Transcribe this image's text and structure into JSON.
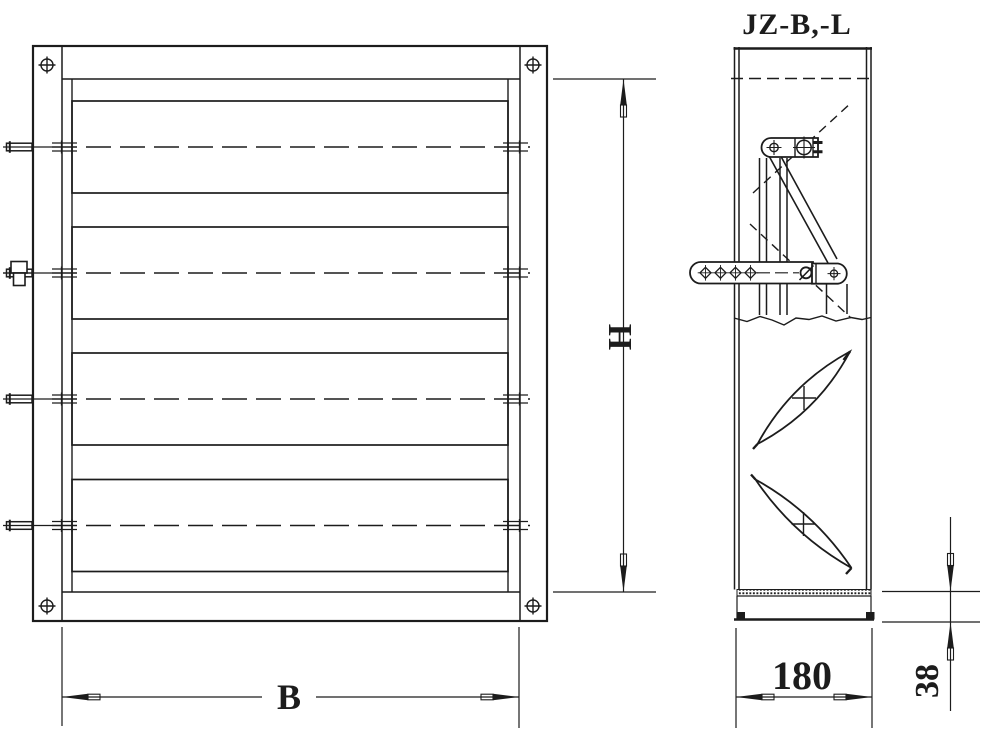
{
  "title": "JZ-B,-L",
  "dimensions": {
    "height_label": "H",
    "width_label": "B",
    "depth_label": "180",
    "channel_height_label": "38"
  },
  "views": {
    "front_view": "front elevation with 4 damper blades",
    "side_view": "side section with linkage and blade profiles"
  },
  "colors": {
    "line": "#1c1c1c",
    "background": "#ffffff"
  }
}
